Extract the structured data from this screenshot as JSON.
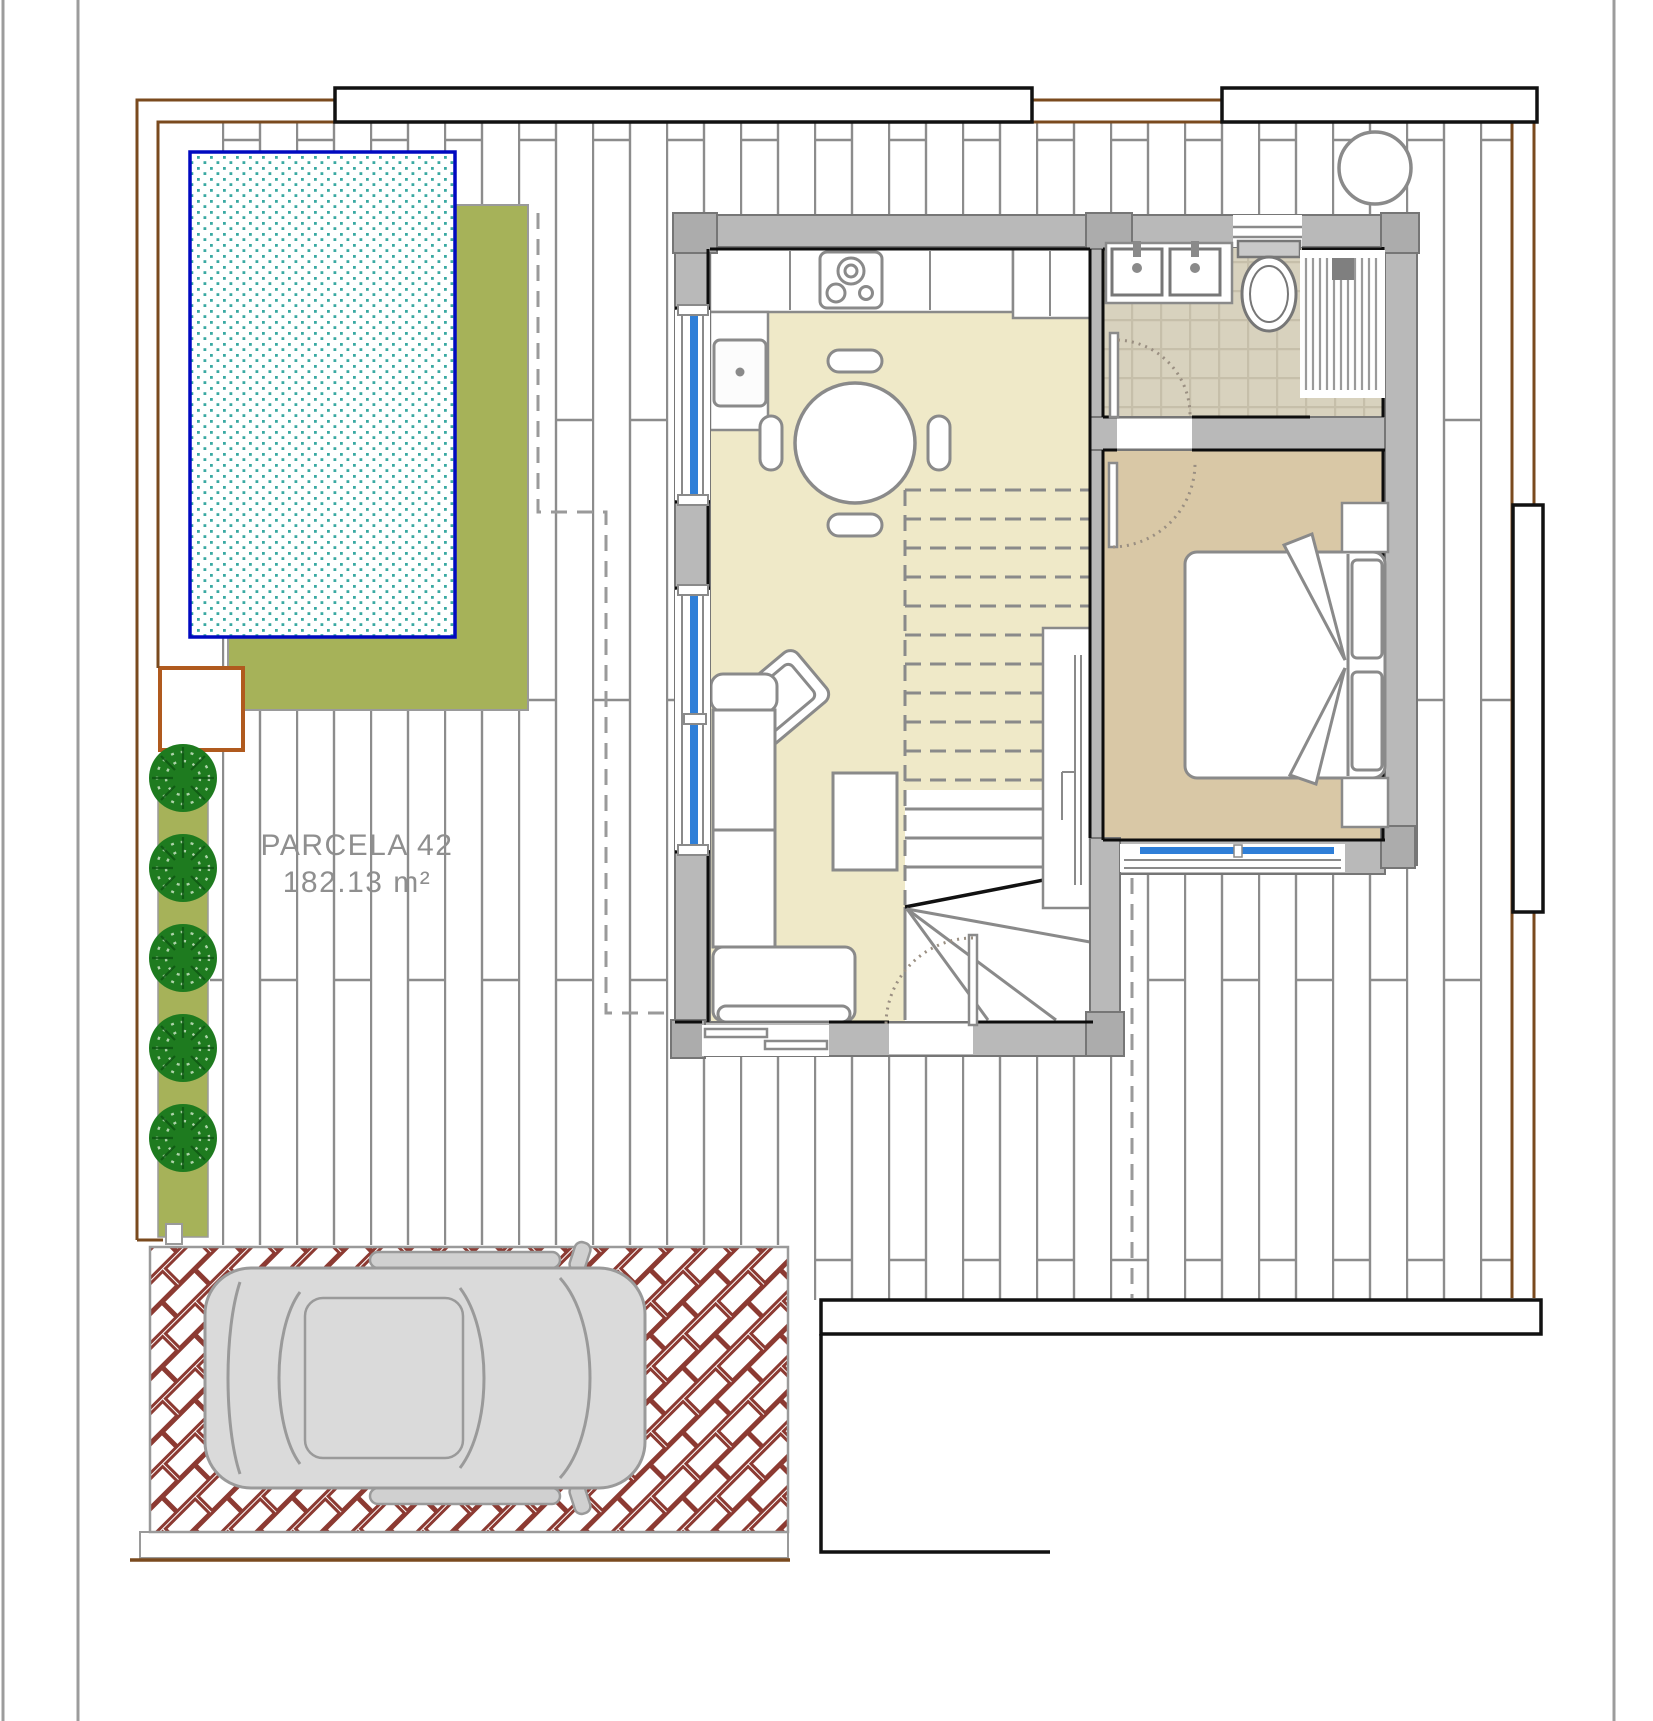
{
  "plan": {
    "parcel": {
      "label": "PARCELA 42",
      "area": "182.13 m²"
    }
  },
  "colors": {
    "boundary_brown": "#7A4A1E",
    "gate_box_orange": "#B05A1E",
    "fence_black": "#111111",
    "page_border_gray": "#9C9C9C",
    "lawn_green": "#A6B259",
    "tree_green": "#1E7B1F",
    "pool_border_blue": "#0009C0",
    "pool_water_teal": "#3AA9A2",
    "terrace_tile_line": "#8C8C8C",
    "wall_gray": "#B9B9B9",
    "wall_pillar_gray": "#ACACAC",
    "wall_outline": "#767676",
    "interior_floor_cream": "#EFE9C8",
    "bedroom_floor_tan": "#D9C8A6",
    "bath_tile_beige": "#D8D2BE",
    "bath_tile_line": "#C6BFAA",
    "window_blue": "#2F7FD8",
    "furniture_line_gray": "#8A8A8A",
    "door_arc_dotted": "#9A8F82",
    "driveway_brick_red": "#8C3A32",
    "car_body_gray": "#DADADA",
    "car_line_gray": "#9A9A9A",
    "label_text_gray": "#8F8F8F"
  }
}
